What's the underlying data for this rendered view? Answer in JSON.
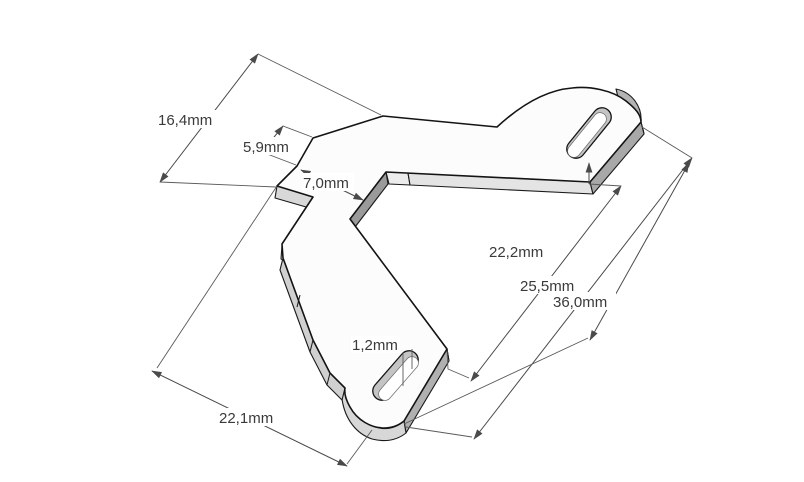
{
  "drawing": {
    "dims": {
      "d16_4": {
        "label": "16,4mm"
      },
      "d5_9": {
        "label": "5,9mm"
      },
      "d7_0": {
        "label": "7,0mm"
      },
      "d22_2": {
        "label": "22,2mm"
      },
      "d25_5": {
        "label": "25,5mm"
      },
      "d36_0": {
        "label": "36,0mm"
      },
      "d1_2": {
        "label": "1,2mm"
      },
      "d22_1": {
        "label": "22,1mm"
      }
    },
    "colors": {
      "background": "#ffffff",
      "outline": "#141414",
      "top_face": "#fcfcfc",
      "side_light": "#dcdcdc",
      "side_medium": "#b0b0b0",
      "side_dark": "#9a9a9a",
      "dimension_line": "#4a4a4a",
      "dimension_text": "#3a3a3a"
    }
  }
}
